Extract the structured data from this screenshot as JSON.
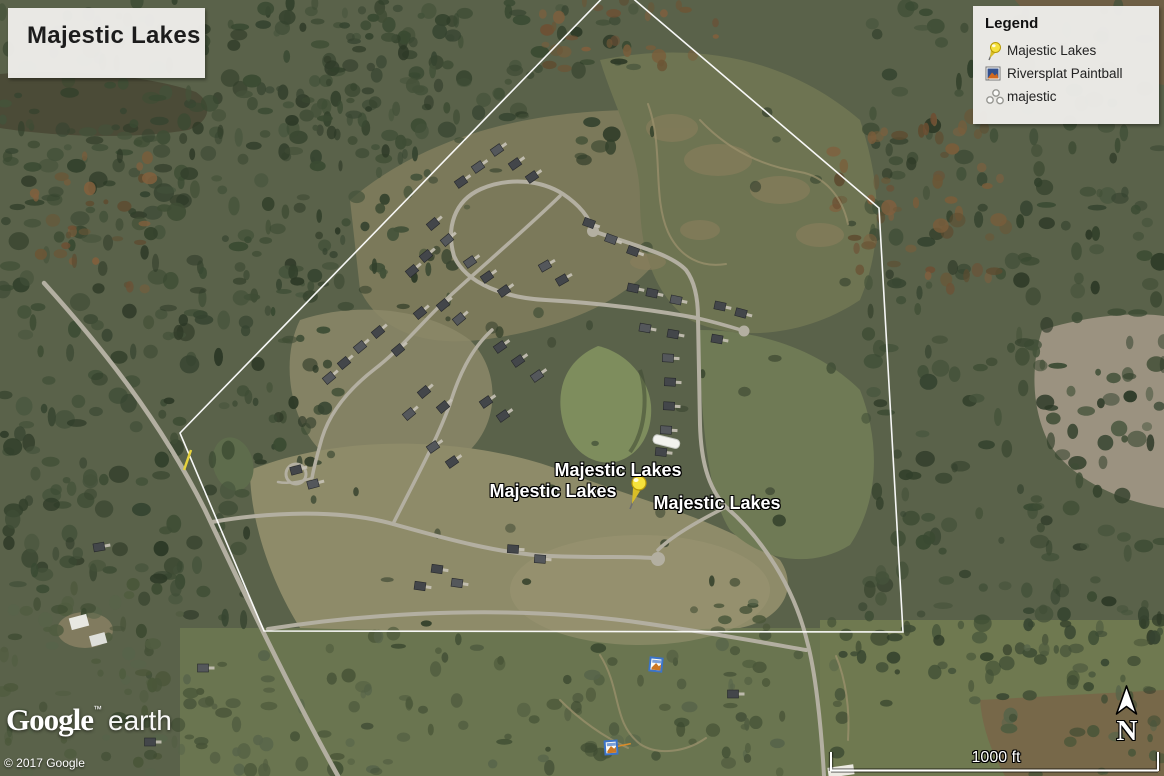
{
  "title_box": {
    "text": "Majestic Lakes"
  },
  "legend": {
    "header": "Legend",
    "items": [
      {
        "label": "Majestic Lakes",
        "icon": "pushpin-icon"
      },
      {
        "label": "Riversplat Paintball",
        "icon": "photo-icon"
      },
      {
        "label": "majestic",
        "icon": "polygon-points-icon"
      }
    ]
  },
  "placemarks": {
    "labels": [
      "Majestic Lakes",
      "Majestic Lakes",
      "Majestic Lakes"
    ]
  },
  "branding": {
    "logo": "Google",
    "tm": "™",
    "product": "earth",
    "copyright": "© 2017 Google"
  },
  "compass": {
    "north": "N"
  },
  "scale": {
    "label": "1000 ft"
  },
  "colors": {
    "boundary": "#ffffff",
    "pushpin_yellow": "#f2d51c",
    "panel_bg": "#edece9",
    "label_text": "#ffffff",
    "road": "#b3afa1",
    "forest_dark": "#3a4831",
    "field_tan": "#8e8b69",
    "pond_green": "#7e8d5d",
    "lake_dark": "#4b4b37"
  }
}
